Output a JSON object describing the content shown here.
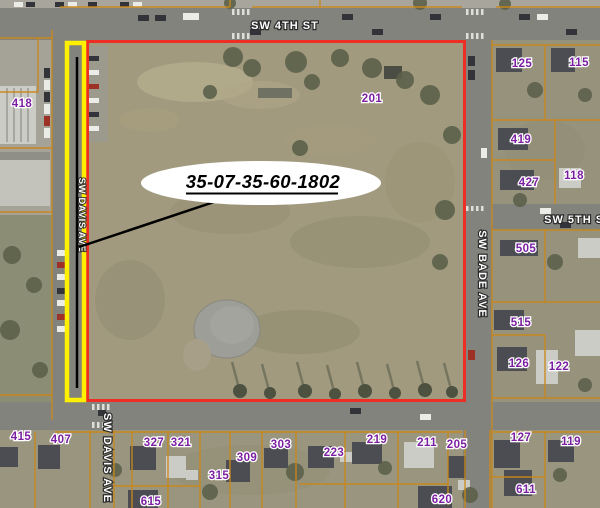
{
  "map": {
    "annotation_parcel_id": "35-07-35-60-1802",
    "streets": {
      "sw_4th_st": "SW 4TH ST",
      "sw_5th_st": "SW 5TH ST",
      "sw_bade_ave": "SW BADE AVE",
      "sw_davis_ave": "SW DAVIS AVE",
      "sw_davis_ave_north": "SW DAVIS AVE"
    },
    "parcel_numbers": {
      "p418": "418",
      "p201": "201",
      "p125": "125",
      "p115": "115",
      "p419": "419",
      "p427": "427",
      "p118": "118",
      "p505": "505",
      "p515": "515",
      "p126": "126",
      "p122": "122",
      "p415": "415",
      "p407": "407",
      "p327": "327",
      "p321": "321",
      "p309": "309",
      "p315": "315",
      "p303": "303",
      "p615": "615",
      "p223": "223",
      "p219": "219",
      "p211": "211",
      "p205": "205",
      "p127": "127",
      "p119": "119",
      "p611": "611",
      "p620": "620"
    },
    "colors": {
      "subject_parcel_outline": "#ee2e24",
      "highlight_box": "#ffef00",
      "parcel_line": "#c9871a",
      "parcel_number_text": "#7b1fa2",
      "street_label_text": "#ffffff",
      "annotation_text": "#000000",
      "callout_fill": "#ffffff",
      "leader_line": "#000000"
    }
  }
}
